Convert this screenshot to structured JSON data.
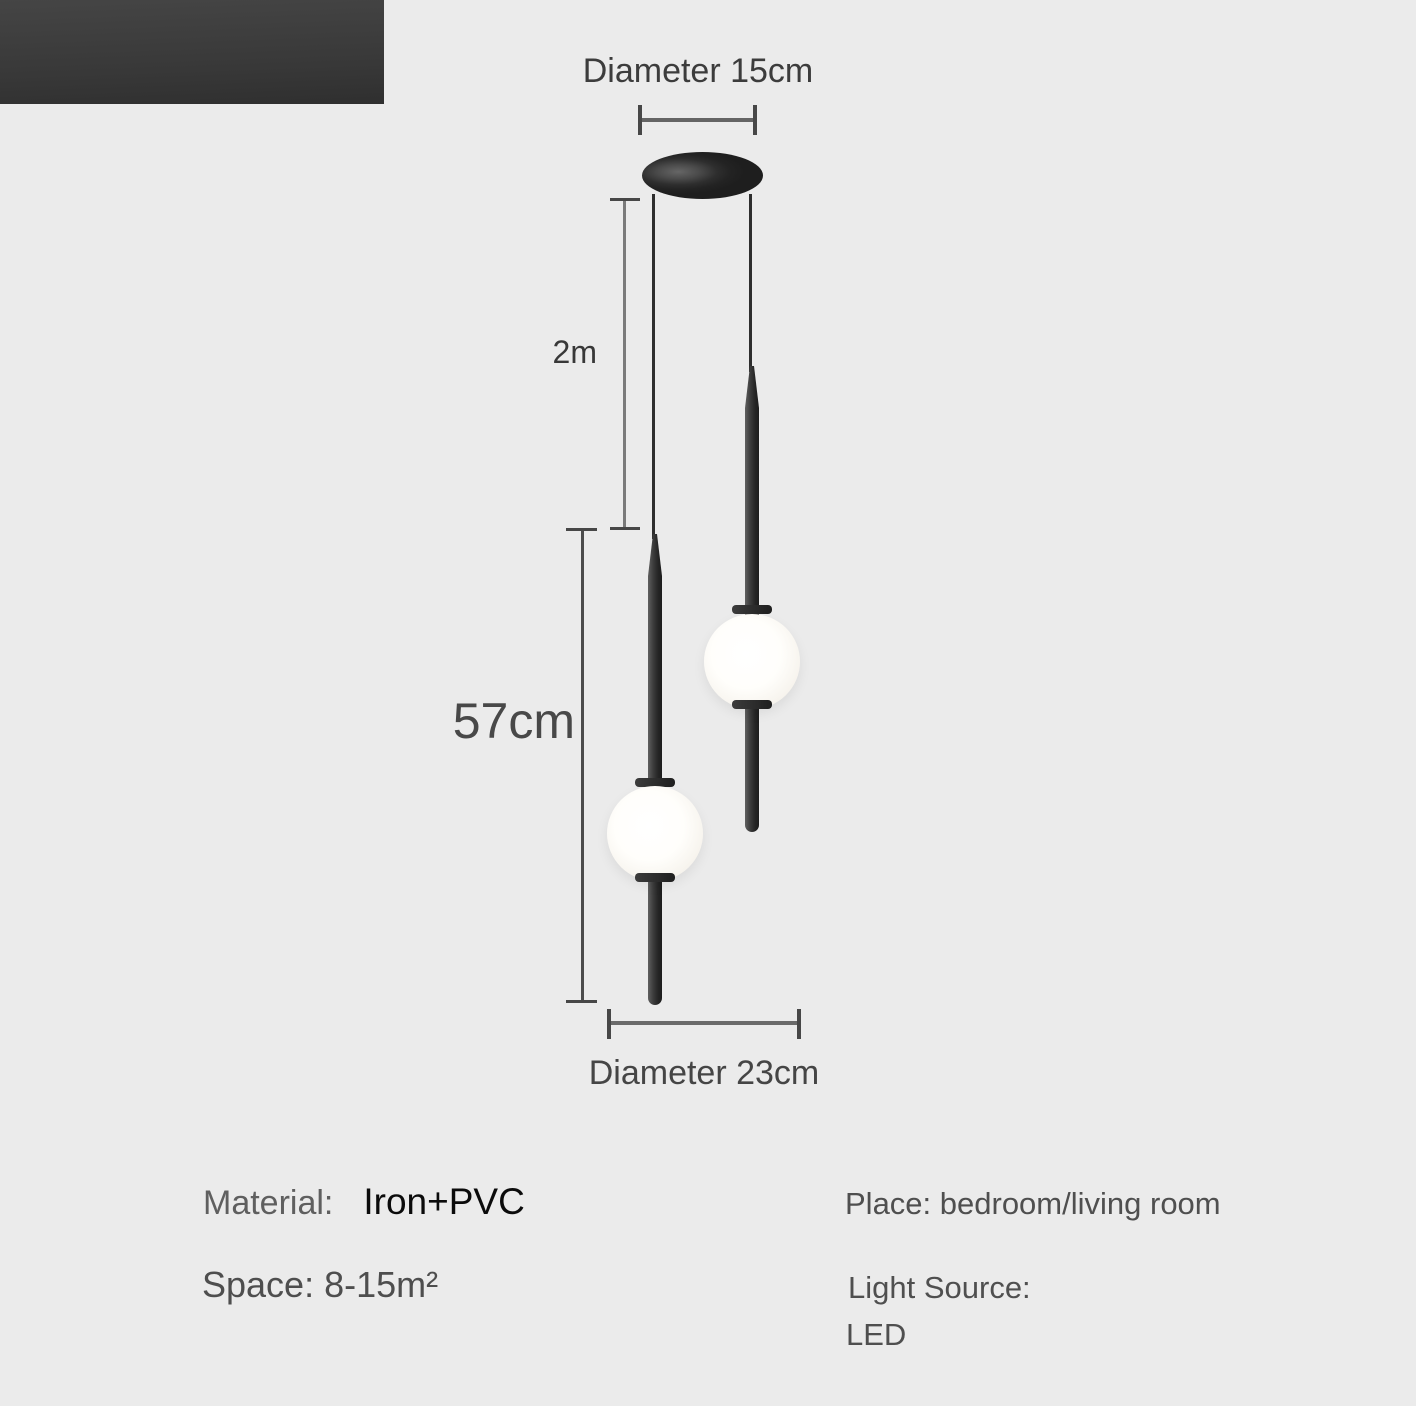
{
  "diagram": {
    "top_diameter_label": "Diameter 15cm",
    "drop_length_label": "2m",
    "fixture_height_label": "57cm",
    "bottom_diameter_label": "Diameter 23cm"
  },
  "specs": {
    "material_label": "Material:",
    "material_value": "Iron+PVC",
    "space_text": "Space: 8-15m²",
    "place_text": "Place: bedroom/living room",
    "light_source_label": "Light Source:",
    "light_source_value": "LED"
  },
  "colors": {
    "background": "#ebebeb",
    "fixture_black": "#232323",
    "globe_white": "#fdfcf8",
    "dimension_line": "#646464",
    "dimension_text": "#3c3c3c",
    "spec_text_gray": "#4f4f4f",
    "spec_text_black": "#0b0b0b",
    "photo_strip_dark": "#3a3a3a"
  }
}
